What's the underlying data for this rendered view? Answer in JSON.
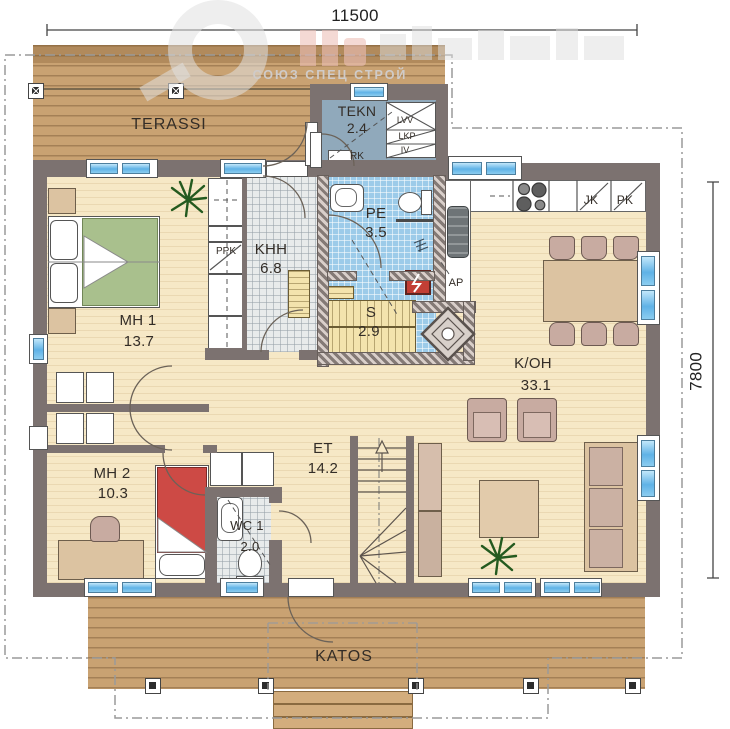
{
  "title": "single-storey house floor plan",
  "dimensions": {
    "top": "11500",
    "right": "7800"
  },
  "watermark": {
    "text": "СОЮЗ СПЕЦ СТРОЙ"
  },
  "rooms": {
    "terassi": {
      "name": "TERASSI",
      "area": ""
    },
    "tekn": {
      "name": "TEKN",
      "area": "2.4"
    },
    "khh": {
      "name": "KHH",
      "area": "6.8"
    },
    "pe": {
      "name": "PE",
      "area": "3.5"
    },
    "sauna": {
      "name": "S",
      "area": "2.9"
    },
    "mh1": {
      "name": "MH 1",
      "area": "13.7"
    },
    "mh2": {
      "name": "MH 2",
      "area": "10.3"
    },
    "wc1": {
      "name": "WC 1",
      "area": "2.0"
    },
    "et": {
      "name": "ET",
      "area": "14.2"
    },
    "koh": {
      "name": "K/OH",
      "area": "33.1"
    },
    "katos": {
      "name": "KATOS",
      "area": ""
    }
  },
  "labels": {
    "ppk": "PPK",
    "rk": "RK",
    "lvv": "LVV",
    "lkp": "LKP",
    "iv": "IV",
    "jk": "JK",
    "pk": "PK",
    "ap": "AP"
  },
  "colors": {
    "wall": "#7c7270",
    "deck": "#c9a272",
    "floor": "#f6e8c6",
    "tile_blue": "#9ccbe9",
    "tile_gray": "#e8ebeb",
    "tekn_floor": "#90a9bb",
    "glass": "#5fb2e6",
    "bed_green": "#a9c08d",
    "bed_red": "#cd4a45",
    "furniture_tan": "#dcc3a1",
    "furniture_mauve": "#c8aba1",
    "sauna_bench": "#f3e3ad"
  }
}
